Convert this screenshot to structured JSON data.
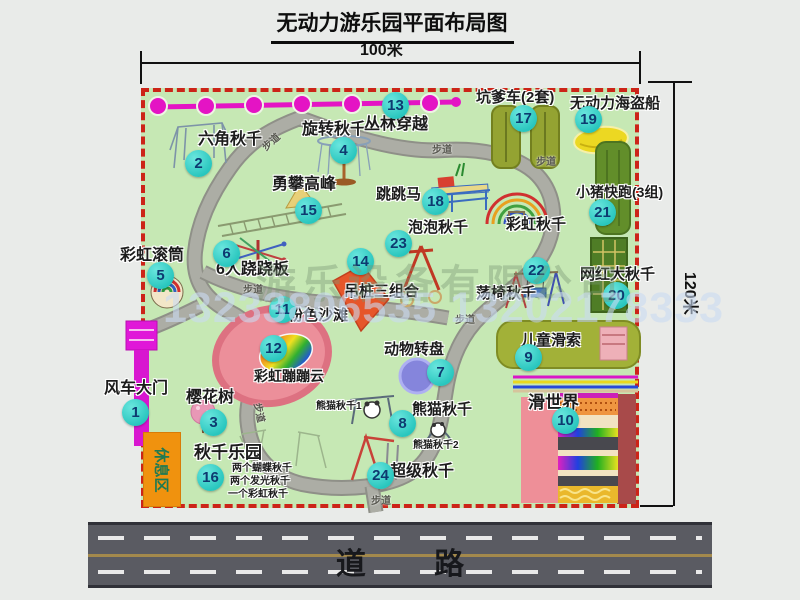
{
  "title": "无动力游乐园平面布局图",
  "scale": {
    "width_label": "100米",
    "height_label": "120米"
  },
  "road_label": "道  路",
  "walkway_label": "步道",
  "rest_area_label": "休息区",
  "rainbow_swing_label": "彩虹秋千",
  "watermark": {
    "company": "游乐设备有限公司",
    "phone": "13233806535 13202178333"
  },
  "attractions": [
    {
      "id": "1",
      "name": "风车大门"
    },
    {
      "id": "2",
      "name": "六角秋千"
    },
    {
      "id": "3",
      "name": "樱花树"
    },
    {
      "id": "4",
      "name": "旋转秋千"
    },
    {
      "id": "5",
      "name": "彩虹滚筒"
    },
    {
      "id": "6",
      "name": "6人跷跷板"
    },
    {
      "id": "7",
      "name": "动物转盘"
    },
    {
      "id": "8",
      "name": "熊猫秋千",
      "subs": [
        "熊猫秋千1",
        "熊猫秋千2"
      ]
    },
    {
      "id": "9",
      "name": "儿童滑索"
    },
    {
      "id": "10",
      "name": "滑世界"
    },
    {
      "id": "11",
      "name": "粉色沙滩"
    },
    {
      "id": "12",
      "name": "彩虹蹦蹦云"
    },
    {
      "id": "13",
      "name": "丛林穿越"
    },
    {
      "id": "14",
      "name": "吊桩三组合"
    },
    {
      "id": "15",
      "name": "勇攀高峰"
    },
    {
      "id": "16",
      "name": "秋千乐园",
      "notes": [
        "两个蝴蝶秋千",
        "两个发光秋千",
        "一个彩虹秋千"
      ]
    },
    {
      "id": "17",
      "name": "坑爹车(2套)"
    },
    {
      "id": "18",
      "name": "跳跳马"
    },
    {
      "id": "19",
      "name": "无动力海盗船"
    },
    {
      "id": "20",
      "name": "网红大秋千"
    },
    {
      "id": "21",
      "name": "小猪快跑(3组)"
    },
    {
      "id": "22",
      "name": "荡椅秋千"
    },
    {
      "id": "23",
      "name": "泡泡秋千"
    },
    {
      "id": "24",
      "name": "超级秋千"
    }
  ],
  "colors": {
    "map_bg": "#c6e8b4",
    "map_border": "#cc2418",
    "badge": "#35d2c8",
    "walkway": "#a9aaa2",
    "road": "#5a5b62",
    "gate": "#d816d0",
    "beaded_line": "#e414c4"
  }
}
